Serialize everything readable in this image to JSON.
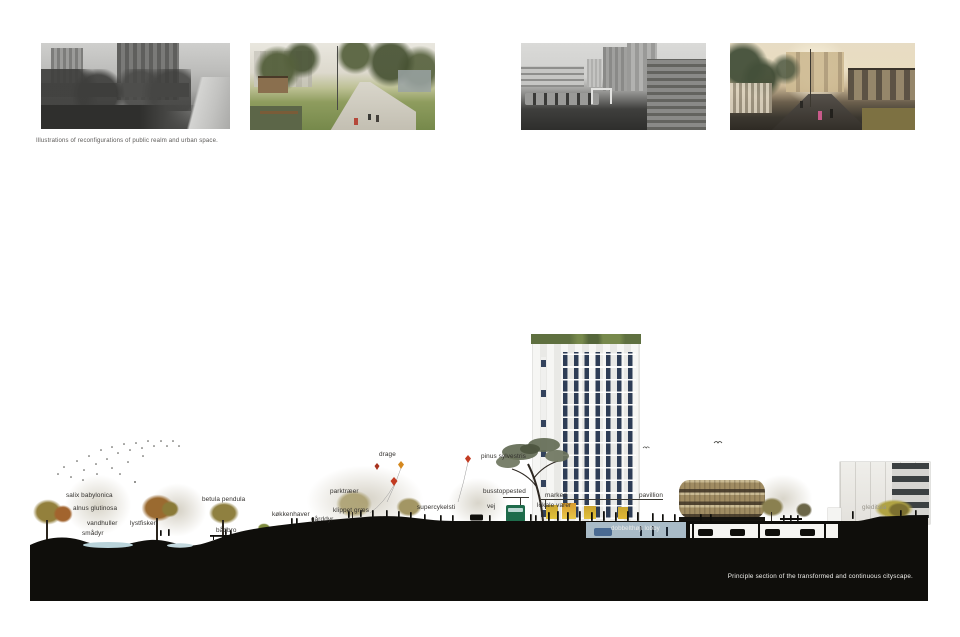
{
  "captions": {
    "top": "Illustrations of reconfigurations of public realm and urban space.",
    "bottom": "Principle section of the transformed and continuous cityscape."
  },
  "section_labels": {
    "salix": "salix babylonica",
    "alnus": "alnus glutinosa",
    "vandhuller": "vandhuller",
    "lystfiskeri": "lystfiskeri",
    "smaadyr": "smådyr",
    "betula": "betula pendula",
    "baadbro": "bådbro",
    "koekkenhaver": "køkkenhaver",
    "gaarddyr": "gårddyr",
    "klippet_graes": "klippet græs",
    "parktraeer": "parktræer",
    "drage": "drage",
    "supercykelsti": "supercykelsti",
    "pinus": "pinus sylvestris",
    "busstoppested": "busstoppested",
    "vej": "vej",
    "marked": "marked",
    "lokale_varer": "lokale varer",
    "pavillion": "pavillion",
    "lobby": "dobbelthøjt lobby",
    "gleditsia": "gleditsia"
  },
  "colors": {
    "ground_black": "#0f0e0b",
    "water_blue": "#b9d3da",
    "tower_window_navy": "#2e3d56",
    "pavilion_band_tan": "#a08c62",
    "bus_green": "#1e6b4b",
    "lobby_strip_blue": "#a9bbc7",
    "kite_red": "#c23b22",
    "kite_orange": "#d4881f",
    "market_yellow": "#e2c23c"
  }
}
